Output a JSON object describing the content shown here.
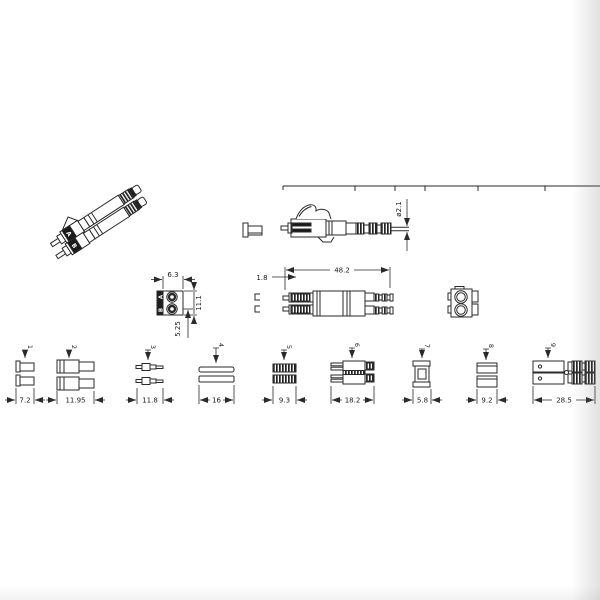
{
  "drawing": {
    "iso_view": {
      "label_a": "A",
      "label_b": "B"
    },
    "front_view": {
      "width": "6.3",
      "height": "11.1",
      "pitch": "5.25",
      "port_a": "A",
      "port_b": "B"
    },
    "plan_view": {
      "overall_length": "48.2",
      "ferrule_tip": "1.8"
    },
    "side_view": {
      "cable_diameter": "ø2.1"
    },
    "parts": [
      {
        "no": "1",
        "dim": "7.2"
      },
      {
        "no": "2",
        "dim": "11.95"
      },
      {
        "no": "3",
        "dim": "11.8"
      },
      {
        "no": "4",
        "dim": "16"
      },
      {
        "no": "5",
        "dim": "9.3"
      },
      {
        "no": "6",
        "dim": "18.2"
      },
      {
        "no": "7",
        "dim": "5.8"
      },
      {
        "no": "8",
        "dim": "9.2"
      },
      {
        "no": "9",
        "dim": "28.5"
      }
    ],
    "colors": {
      "line": "#2a2a2a",
      "fill_dark": "#1a1a1a",
      "background": "#ffffff"
    }
  }
}
